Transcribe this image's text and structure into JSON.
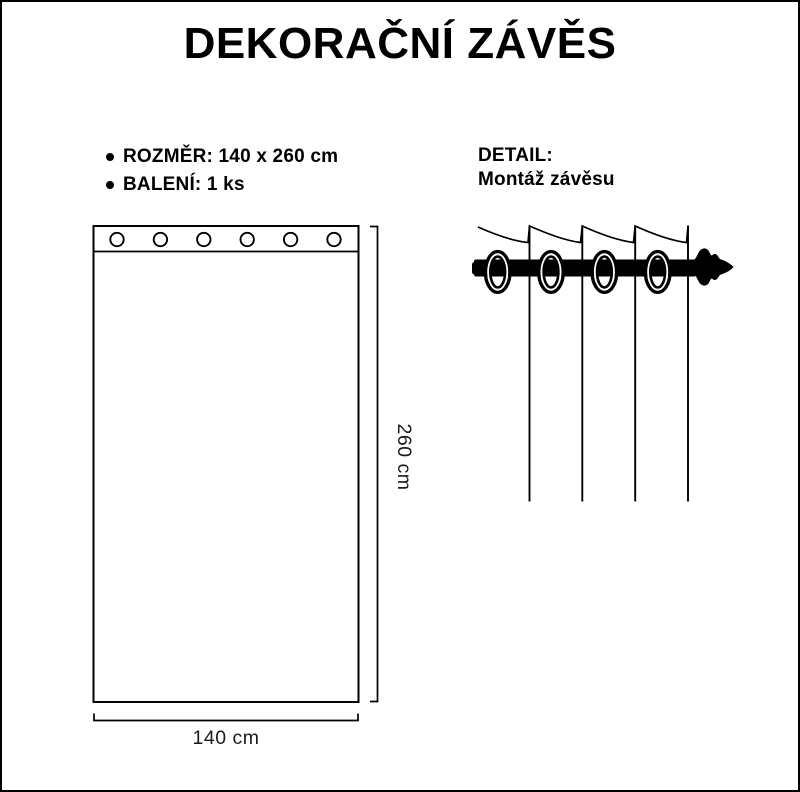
{
  "title": "DEKORAČNÍ ZÁVĚS",
  "specs": {
    "bullet_glyph": "●",
    "items": [
      "ROZMĚR: 140 x 260 cm",
      "BALENÍ: 1 ks"
    ]
  },
  "detail": {
    "heading": "DETAIL:",
    "subheading": "Montáž závěsu"
  },
  "dimensions": {
    "width_label": "140 cm",
    "height_label": "260 cm"
  },
  "diagram": {
    "grommet_count": 6,
    "eyelet_count": 4
  },
  "colors": {
    "ink": "#000000",
    "background": "#ffffff"
  }
}
